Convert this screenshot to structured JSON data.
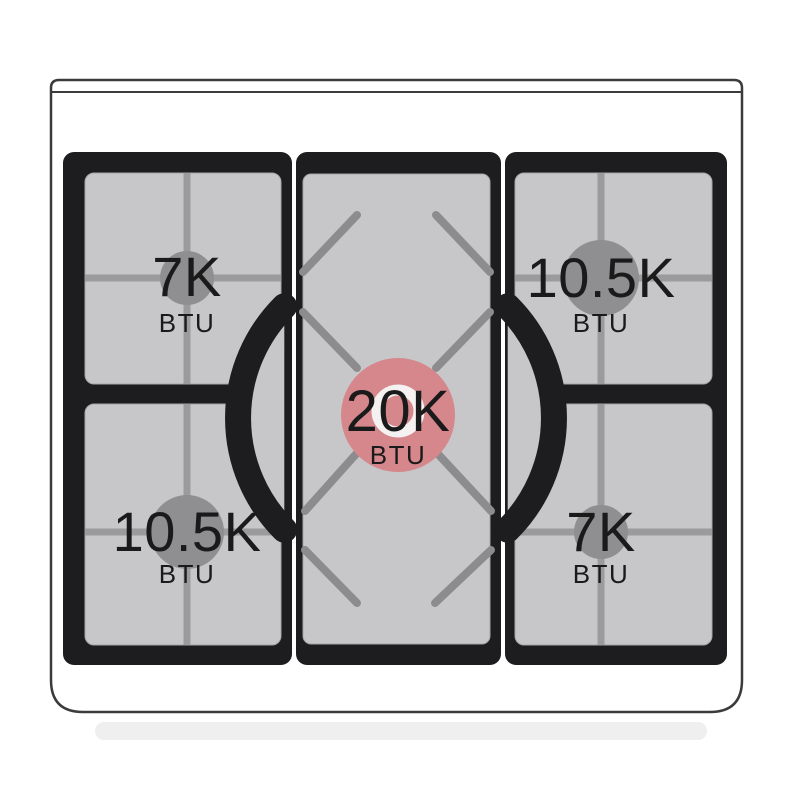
{
  "diagram": {
    "kind": "gas-range-cooktop-burner-btu-diagram",
    "burners": {
      "top_left": {
        "position": "top-left",
        "power": "7K",
        "unit": "BTU"
      },
      "top_right": {
        "position": "top-right",
        "power": "10.5K",
        "unit": "BTU"
      },
      "center": {
        "position": "center",
        "power": "20K",
        "unit": "BTU"
      },
      "bottom_left": {
        "position": "bottom-left",
        "power": "10.5K",
        "unit": "BTU"
      },
      "bottom_right": {
        "position": "bottom-right",
        "power": "7K",
        "unit": "BTU"
      }
    },
    "colors": {
      "center_burner_highlight": "#d5878c",
      "center_burner_ring": "#f4f1f0",
      "side_burner": "#8f8f91",
      "grate_frame_black": "#1d1d1f",
      "grate_surface_gray": "#c7c7c9",
      "grate_line_gray": "#9b9b9d",
      "body_outline": "#3b3b3d",
      "label_text": "#1a1a1a"
    }
  }
}
